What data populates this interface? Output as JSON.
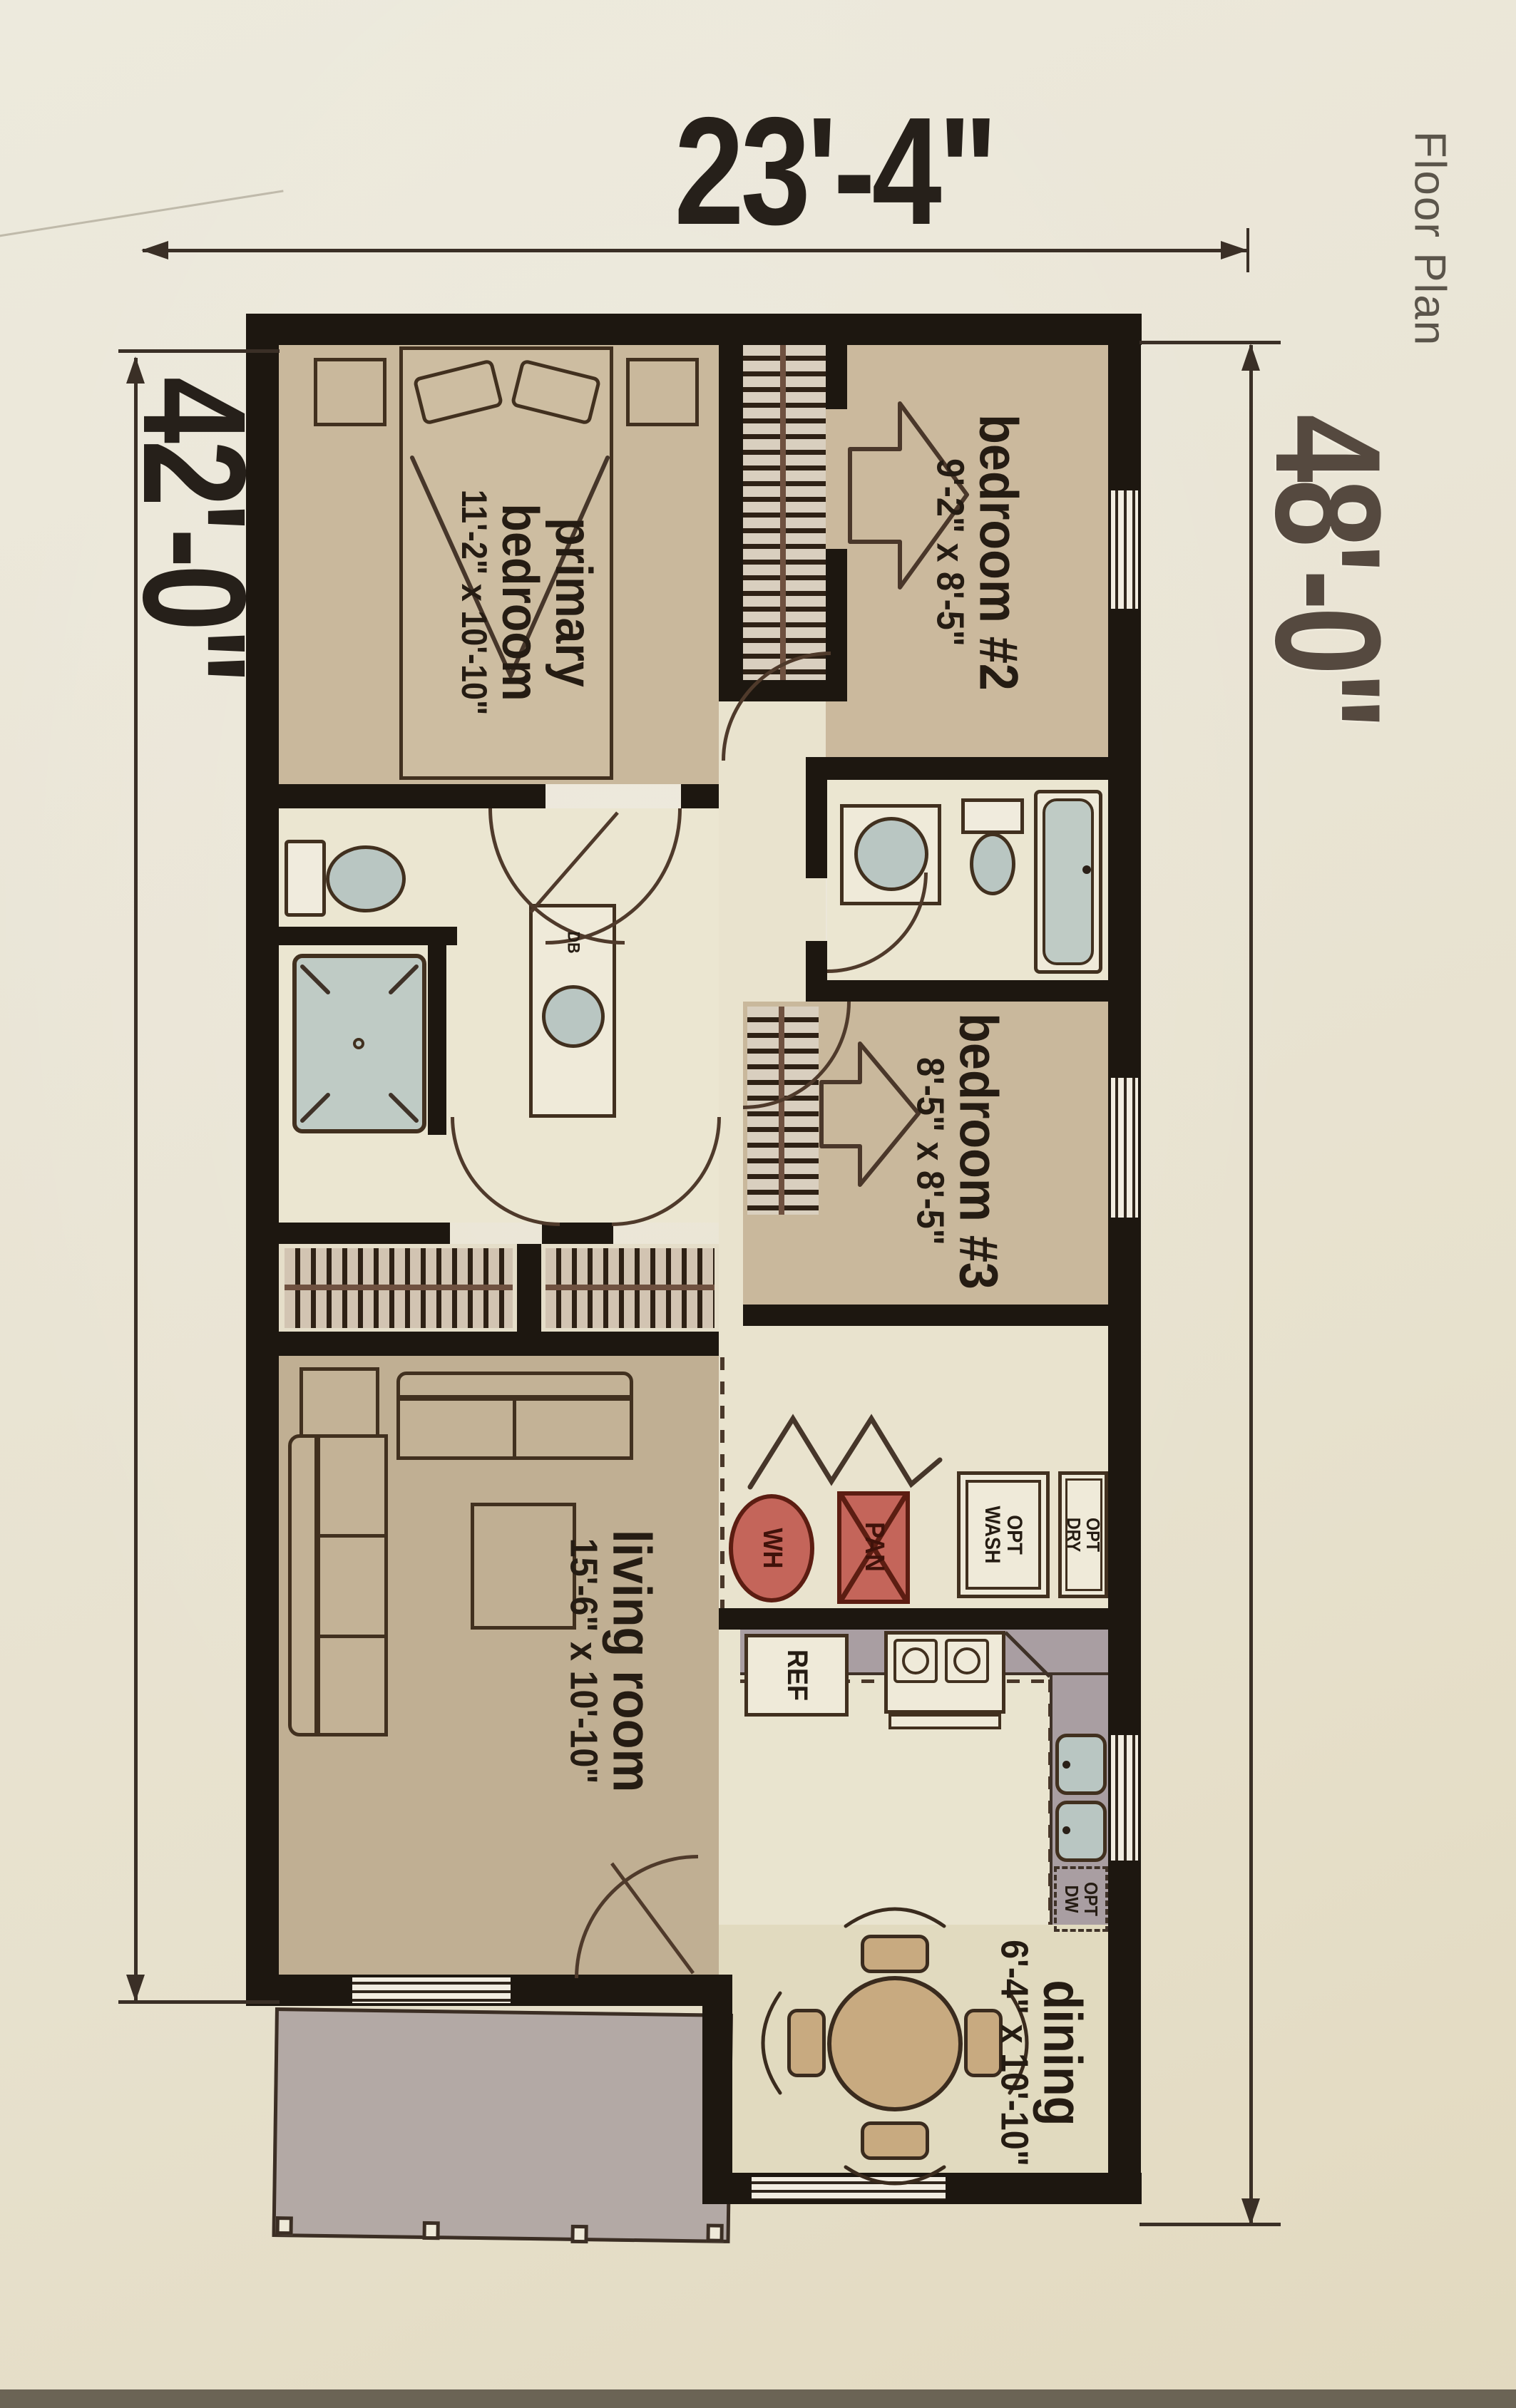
{
  "title": "Floor Plan",
  "dimensions": {
    "width_top": "23'-4\"",
    "height_left": "42'-0\"",
    "height_right": "48'-0\""
  },
  "rooms": {
    "primary_bedroom": {
      "name_line1": "primary",
      "name_line2": "bedroom",
      "size": "11'-2\" x 10'-10\""
    },
    "bedroom_2": {
      "name": "bedroom #2",
      "size": "9'-2\" x 8'-5\""
    },
    "bedroom_3": {
      "name": "bedroom #3",
      "size": "8'-5\" x 8'-5\""
    },
    "living_room": {
      "name": "living room",
      "size": "15'-6\" x 10'-10\""
    },
    "dining": {
      "name": "dining",
      "size": "6'-4\" x 10'-10\""
    }
  },
  "appliances": {
    "water_heater": "WH",
    "pantry": "PAN",
    "washer_line1": "OPT",
    "washer_line2": "WASH",
    "dryer_line1": "OPT",
    "dryer_line2": "DRY",
    "refrigerator": "REF",
    "dishwasher_line1": "OPT",
    "dishwasher_line2": "DW",
    "vanity_drawer_base": "DB"
  },
  "colors": {
    "wall": "#1d1710",
    "room_tan": "#c9b89c",
    "room_cream": "#ebe6d1",
    "accent_red": "#c4655a",
    "fixture_blue": "#b9c6c2",
    "deck_gray": "#b3a9a5",
    "counter_gray": "#a99ea2",
    "paper": "#e9e4d4"
  }
}
